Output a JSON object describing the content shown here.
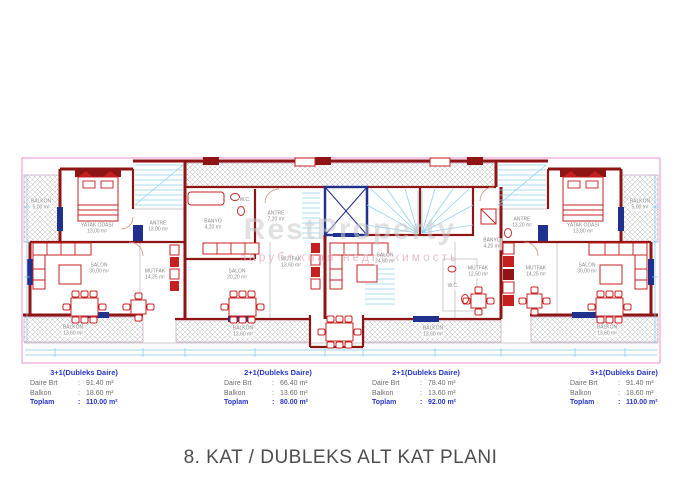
{
  "title": "8. KAT / DUBLEKS ALT KAT PLANI",
  "colon": ":",
  "plan": {
    "watermark": {
      "line1": "RestProperty",
      "line2": "зарубежная недвижимость"
    },
    "rooms": [
      {
        "name": "BALKON",
        "area": "5,00 m²"
      },
      {
        "name": "YATAK ODASI",
        "area": "13,00 m²"
      },
      {
        "name": "ANTRE",
        "area": "13,00 m²"
      },
      {
        "name": "SALON",
        "area": "30,00 m²"
      },
      {
        "name": "MUTFAK",
        "area": "14,25 m²"
      },
      {
        "name": "BALKON",
        "area": "13,60 m²"
      },
      {
        "name": "BANYO",
        "area": "4,20 m²"
      },
      {
        "name": "W.C.",
        "area": ""
      },
      {
        "name": "ANTRE",
        "area": "7,20 m²"
      },
      {
        "name": "MUTFAK",
        "area": "13,60 m²"
      },
      {
        "name": "SALON",
        "area": "20,20 m²"
      },
      {
        "name": "BALKON",
        "area": "13,60 m²"
      },
      {
        "name": "SALON",
        "area": "24,80 m²"
      },
      {
        "name": "W.C.",
        "area": ""
      },
      {
        "name": "MUTFAK",
        "area": "12,50 m²"
      },
      {
        "name": "BALKON",
        "area": "13,60 m²"
      },
      {
        "name": "MUTFAK",
        "area": "14,25 m²"
      },
      {
        "name": "BANYO",
        "area": "4,20 m²"
      },
      {
        "name": "ANTRE",
        "area": "13,20 m²"
      },
      {
        "name": "YATAK ODASI",
        "area": "13,80 m²"
      },
      {
        "name": "BALKON",
        "area": "5,00 m²"
      },
      {
        "name": "SALON",
        "area": "30,00 m²"
      },
      {
        "name": "BALKON",
        "area": "13,60 m²"
      }
    ]
  },
  "apartments": [
    {
      "header": "3+1(Dubleks Daire)",
      "rows": [
        {
          "label": "Daire Brt",
          "value": "91.40 m²"
        },
        {
          "label": "Balkon",
          "value": "18.60 m²"
        },
        {
          "label": "Toplam",
          "value": "110.00 m²"
        }
      ]
    },
    {
      "header": "2+1(Dubleks Daire)",
      "rows": [
        {
          "label": "Daire Brt",
          "value": "66.40 m²"
        },
        {
          "label": "Balkon",
          "value": "13.60 m²"
        },
        {
          "label": "Toplam",
          "value": "80.00 m²"
        }
      ]
    },
    {
      "header": "2+1(Dubleks Daire)",
      "rows": [
        {
          "label": "Daire Brt",
          "value": "78.40 m²"
        },
        {
          "label": "Balkon",
          "value": "13.60 m²"
        },
        {
          "label": "Toplam",
          "value": "92.00 m²"
        }
      ]
    },
    {
      "header": "3+1(Dubleks Daire)",
      "rows": [
        {
          "label": "Daire Brt",
          "value": "91.40 m²"
        },
        {
          "label": "Balkon",
          "value": "18.60 m²"
        },
        {
          "label": "Toplam",
          "value": "110.00 m²"
        }
      ]
    }
  ],
  "colors": {
    "wall": "#8f1414",
    "red": "#c42020",
    "navy": "#20308f",
    "cyan": "#8fd2ee",
    "dim": "#7fc9e8",
    "hatch": "#b5b5b5",
    "pink": "#f0a2d6",
    "label": "#8a8a8a",
    "blue": "#2837c8",
    "gray": "#6b6b6b",
    "title": "#4d4d4d",
    "wm1": "#c9c9c9",
    "wm2": "#e2aec2"
  }
}
